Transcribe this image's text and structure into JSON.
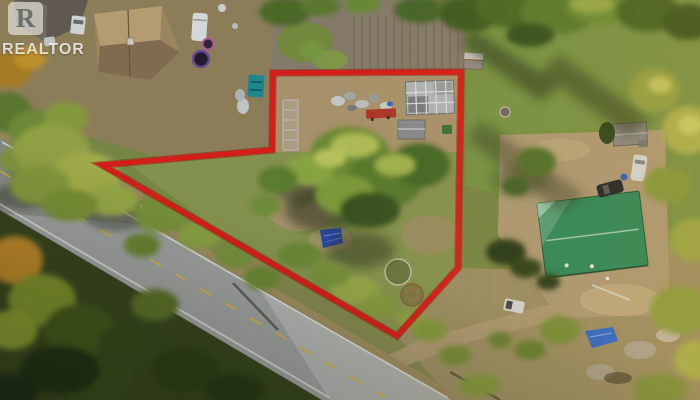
{
  "watermark": {
    "logo_letter": "R",
    "label": "REALTOR"
  },
  "boundary": {
    "points": "273,73 461,72 458,268 397,336 102,165 272,150",
    "color": "#e2211b",
    "stroke_width": "5.5"
  },
  "colors": {
    "road_gray": "#a4a7a6",
    "roof_green": "#2f9160",
    "tarp_blue": "#2b51c9",
    "tarp_blue_2": "#2e6fd6",
    "dumpster_teal": "#1f9099",
    "trailer_red": "#b7392b"
  }
}
